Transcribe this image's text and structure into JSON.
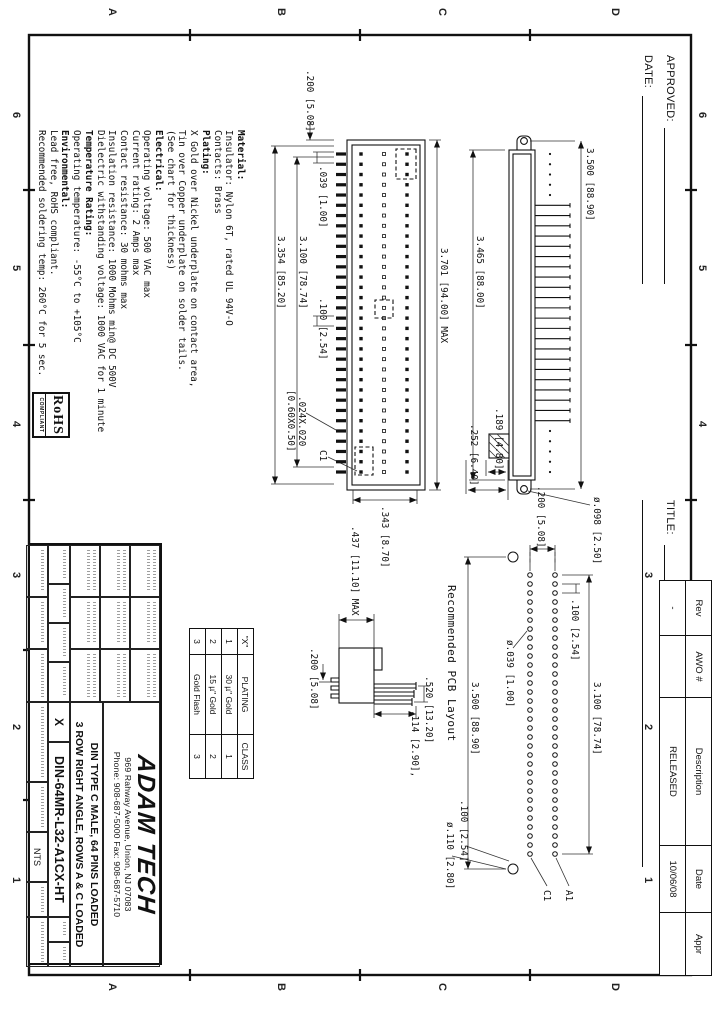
{
  "sheet": {
    "cols": [
      "6",
      "5",
      "4",
      "3",
      "2",
      "1"
    ],
    "rows": [
      "D",
      "C",
      "B",
      "A"
    ]
  },
  "header": {
    "approved_label": "APPROVED:",
    "date_label": "DATE:",
    "title_label": "TITLE:"
  },
  "rev_table": {
    "headers": [
      "Rev",
      "AWO #",
      "Description",
      "Date",
      "Appr"
    ],
    "rows": [
      [
        "-",
        "",
        "RELEASED",
        "10/06/08",
        ""
      ]
    ]
  },
  "notes": {
    "lines": [
      {
        "b": 1,
        "t": "Material:"
      },
      {
        "b": 0,
        "t": "Insulator: Nylon 6T, rated UL 94V-O"
      },
      {
        "b": 0,
        "t": "Contacts: Brass"
      },
      {
        "b": 1,
        "t": "Plating:"
      },
      {
        "b": 0,
        "t": "X Gold over Nickel underplate on contact area,"
      },
      {
        "b": 0,
        "t": "Tin over Copper underplate on solder tails."
      },
      {
        "b": 0,
        "t": "(See chart for thickness)"
      },
      {
        "b": 1,
        "t": "Electrical:"
      },
      {
        "b": 0,
        "t": "Operating voltage: 500 VAC max"
      },
      {
        "b": 0,
        "t": "Current rating: 2 Amps max"
      },
      {
        "b": 0,
        "t": "Contact resistance: 30 mohms max"
      },
      {
        "b": 0,
        "t": "Insulation resistance: 1000 Mohms min@ DC 500V"
      },
      {
        "b": 0,
        "t": "Dielectric withstanding voltage: 1000 VAC for 1 minute"
      },
      {
        "b": 1,
        "t": "Temperature Rating:"
      },
      {
        "b": 0,
        "t": "Operating temperature: -55°C to +105°C"
      },
      {
        "b": 1,
        "t": "Environmental:"
      },
      {
        "b": 0,
        "t": "Lead free, RoHS compliant."
      },
      {
        "b": 0,
        "t": "Recommended soldering temp: 260°C for 5 sec."
      }
    ]
  },
  "rohs": {
    "title": "RoHS",
    "subtitle": "COMPLIANT"
  },
  "plating_table": {
    "headers": [
      "\"X\"",
      "PLATING",
      "CLASS"
    ],
    "rows": [
      [
        "1",
        "30 µ\" Gold",
        "1"
      ],
      [
        "2",
        "15 µ\" Gold",
        "2"
      ],
      [
        "3",
        "Gold Flash",
        "3"
      ]
    ]
  },
  "title_block": {
    "company": "ADAM TECH",
    "address": "969 Rahway Avenue, Union, NJ 07083",
    "phone": "Phone: 908-687-5000 Fax: 908-687-5710",
    "description_line1": "DIN TYPE C MALE, 64 PINS LOADED",
    "description_line2": "3 ROW RIGHT ANGLE, ROWS A & C LOADED",
    "part_number": "DIN-64MR-L32-A1CX-HT",
    "plating_code": "X",
    "scale": "NTS"
  },
  "pcb": {
    "caption": "Recommended PCB Layout"
  },
  "connector": {
    "pins_per_row": 32,
    "rows_loaded": [
      "A",
      "C"
    ],
    "total_pins": 64
  },
  "dims": [
    {
      "t": "3.500 [88.90]",
      "x": 148,
      "y": 133
    },
    {
      "t": "3.465 [88.00]",
      "x": 236,
      "y": 243
    },
    {
      "t": ".189 [4.80]",
      "x": 408,
      "y": 224
    },
    {
      "t": ".252 [6.40]",
      "x": 424,
      "y": 249
    },
    {
      "t": "ø.098 [2.50]",
      "x": 497,
      "y": 126
    },
    {
      "t": "3.701 [94.00] MAX",
      "x": 248,
      "y": 279
    },
    {
      "t": ".200 [5.08]",
      "x": 70,
      "y": 413
    },
    {
      "t": ".039 [1.00]",
      "x": 166,
      "y": 400
    },
    {
      "t": ".100 [2.54]",
      "x": 298,
      "y": 400
    },
    {
      "t": "3.100 [78.74]",
      "x": 236,
      "y": 420
    },
    {
      "t": "3.354 [85.20]",
      "x": 236,
      "y": 442
    },
    {
      "t": ".024X.020",
      "x": 396,
      "y": 421
    },
    {
      "t": "[0.60X0.50]",
      "x": 390,
      "y": 432
    },
    {
      "t": ".343 [8.70]",
      "x": 506,
      "y": 338
    },
    {
      "t": "C1",
      "x": 450,
      "y": 400
    },
    {
      "t": ".437 [11.10] MAX",
      "x": 526,
      "y": 368
    },
    {
      "t": ".520 [13.20]",
      "x": 676,
      "y": 294
    },
    {
      "t": ".114 [2.90],",
      "x": 710,
      "y": 308
    },
    {
      "t": ".200 [5.08]",
      "x": 648,
      "y": 409
    },
    {
      "t": ".100 [2.54]",
      "x": 599,
      "y": 148
    },
    {
      "t": "3.100 [78.74]",
      "x": 682,
      "y": 126
    },
    {
      "t": "3.500 [88.90]",
      "x": 682,
      "y": 248
    },
    {
      "t": ".200 [5.08]",
      "x": 486,
      "y": 182
    },
    {
      "t": "ø.039 [1.00]",
      "x": 640,
      "y": 213
    },
    {
      "t": ".100 [2.54]",
      "x": 800,
      "y": 259
    },
    {
      "t": "ø.110 [2.80]",
      "x": 822,
      "y": 273
    },
    {
      "t": "A1",
      "x": 890,
      "y": 154
    },
    {
      "t": "C1",
      "x": 890,
      "y": 176
    }
  ]
}
